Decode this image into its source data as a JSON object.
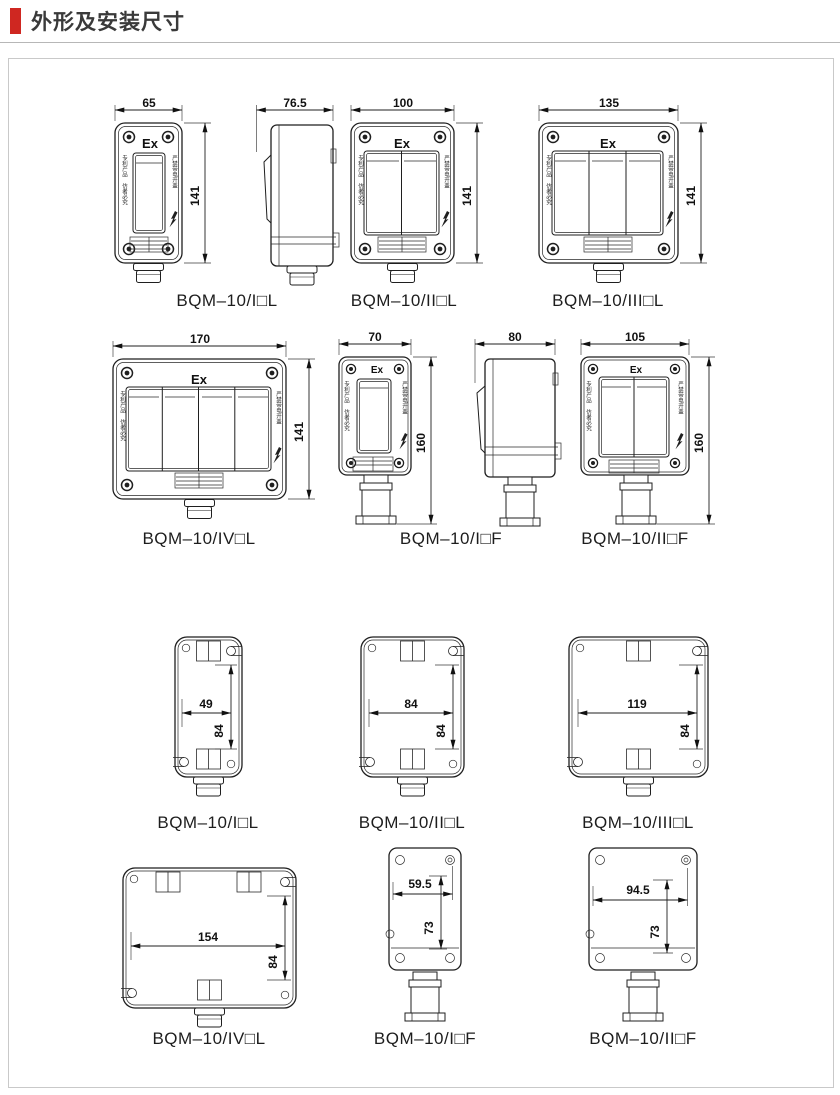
{
  "header": {
    "title": "外形及安装尺寸"
  },
  "colors": {
    "accent_red": "#cf2721",
    "line_work": "#1f1f1f",
    "panel_border": "#c9c9c9"
  },
  "markings": {
    "ex": "Ex",
    "left_label": "专利产品 仿者必究",
    "right_label": "严禁带电开盖",
    "lightning_icon": "lightning-bolt"
  },
  "figures": {
    "f1": {
      "label": "BQM–10/I□L",
      "width": "65",
      "height": "141"
    },
    "f1s": {
      "width": "76.5"
    },
    "f2": {
      "label": "BQM–10/II□L",
      "width": "100",
      "height": "141"
    },
    "f3": {
      "label": "BQM–10/III□L",
      "width": "135",
      "height": "141"
    },
    "f4": {
      "label": "BQM–10/IV□L",
      "width": "170",
      "height": "141"
    },
    "f5": {
      "label": "BQM–10/I□F",
      "width": "70",
      "height": "160"
    },
    "f5s": {
      "width": "80"
    },
    "f6": {
      "label": "BQM–10/II□F",
      "width": "105",
      "height": "160"
    },
    "b1": {
      "label": "BQM–10/I□L",
      "width": "49",
      "height": "84"
    },
    "b2": {
      "label": "BQM–10/II□L",
      "width": "84",
      "height": "84"
    },
    "b3": {
      "label": "BQM–10/III□L",
      "width": "119",
      "height": "84"
    },
    "b4": {
      "label": "BQM–10/IV□L",
      "width": "154",
      "height": "84"
    },
    "b5": {
      "label": "BQM–10/I□F",
      "width": "59.5",
      "height": "73"
    },
    "b6": {
      "label": "BQM–10/II□F",
      "width": "94.5",
      "height": "73"
    }
  }
}
